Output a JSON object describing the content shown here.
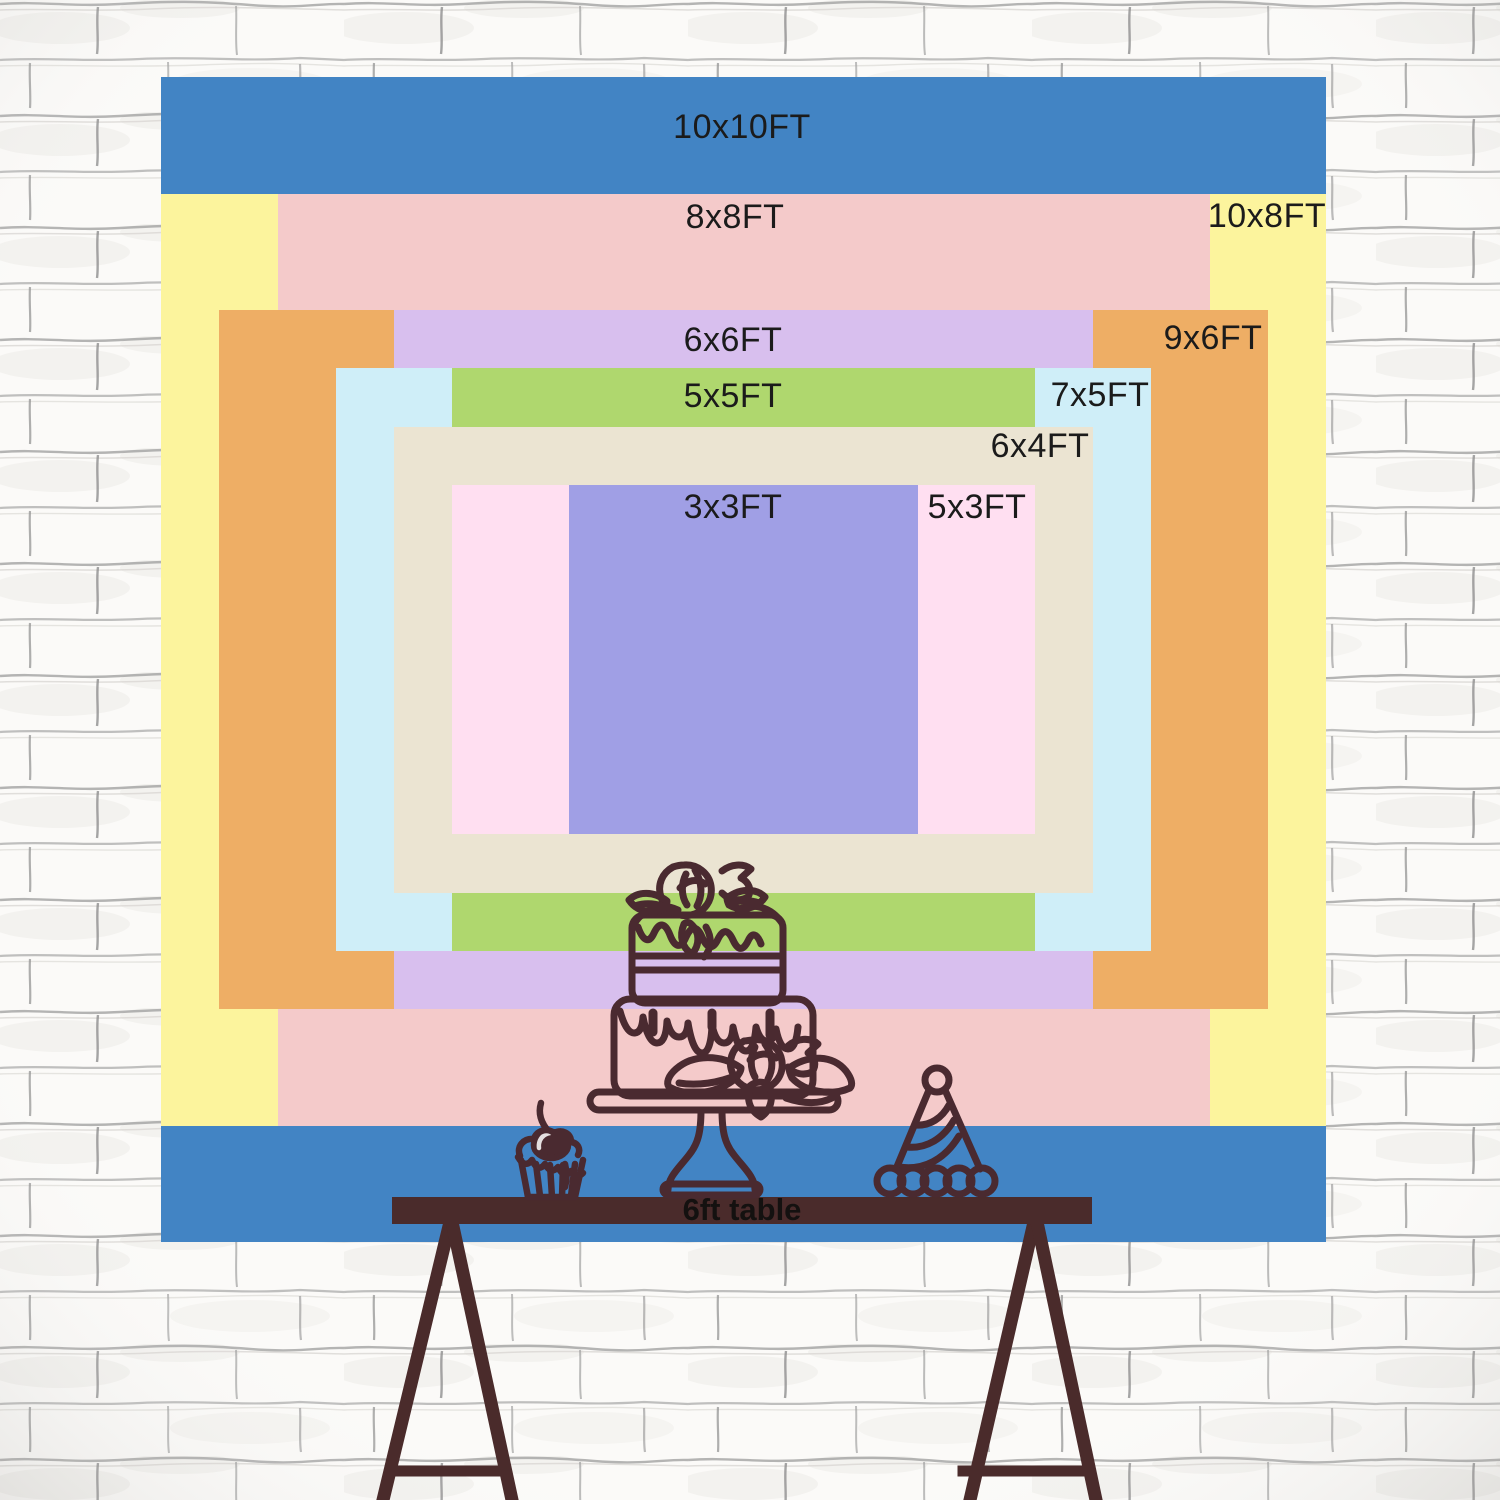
{
  "scene": {
    "background": "white-brick-wall-sketch",
    "wall_color": "#fbfaf8",
    "mortar_color": "#9e9e9e"
  },
  "size_chart": {
    "unit": "FT",
    "label_color": "#1b1b1b",
    "sizes": [
      {
        "id": "10x10",
        "label": "10x10FT",
        "w_ft": 10,
        "h_ft": 10,
        "color": "#4284c4",
        "label_x": 742,
        "label_y": 127
      },
      {
        "id": "10x8",
        "label": "10x8FT",
        "w_ft": 10,
        "h_ft": 8,
        "color": "#fcf49d",
        "label_x": 1267,
        "label_y": 216
      },
      {
        "id": "8x8",
        "label": "8x8FT",
        "w_ft": 8,
        "h_ft": 8,
        "color": "#f4caca",
        "label_x": 735,
        "label_y": 217
      },
      {
        "id": "9x6",
        "label": "9x6FT",
        "w_ft": 9,
        "h_ft": 6,
        "color": "#eeae65",
        "label_x": 1213,
        "label_y": 338
      },
      {
        "id": "6x6",
        "label": "6x6FT",
        "w_ft": 6,
        "h_ft": 6,
        "color": "#d8bfee",
        "label_x": 733,
        "label_y": 340
      },
      {
        "id": "7x5",
        "label": "7x5FT",
        "w_ft": 7,
        "h_ft": 5,
        "color": "#cfeef8",
        "label_x": 1100,
        "label_y": 395
      },
      {
        "id": "5x5",
        "label": "5x5FT",
        "w_ft": 5,
        "h_ft": 5,
        "color": "#afd76e",
        "label_x": 733,
        "label_y": 396
      },
      {
        "id": "6x4",
        "label": "6x4FT",
        "w_ft": 6,
        "h_ft": 4,
        "color": "#ebe4d2",
        "label_x": 1040,
        "label_y": 446
      },
      {
        "id": "5x3",
        "label": "5x3FT",
        "w_ft": 5,
        "h_ft": 3,
        "color": "#ffdff1",
        "label_x": 977,
        "label_y": 507
      },
      {
        "id": "3x3",
        "label": "3x3FT",
        "w_ft": 3,
        "h_ft": 3,
        "color": "#a09fe5",
        "label_x": 733,
        "label_y": 507
      }
    ]
  },
  "table": {
    "label": "6ft table",
    "color": "#4a2b2b"
  },
  "artwork": {
    "line_color": "#4a2a30",
    "items": [
      "birthday-cake",
      "cupcake-with-cherry",
      "party-hat"
    ]
  }
}
